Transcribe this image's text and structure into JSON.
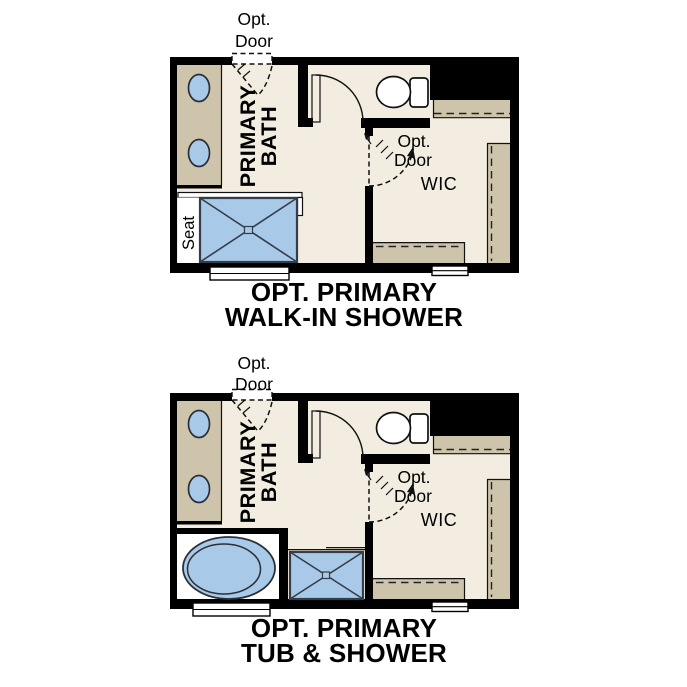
{
  "page": {
    "background": "#ffffff",
    "description": "Two stacked floor-plan option diagrams for a primary bathroom"
  },
  "colors": {
    "wall": "#000000",
    "floor": "#f2ede0",
    "casework": "#cdc4ab",
    "fixture_fill": "#a9c9e8",
    "fixture_outline": "#2b3038",
    "glass": "#ffffff",
    "label_text": "#000000"
  },
  "figures": [
    {
      "id": "walk-in-shower-option",
      "caption": {
        "line1": "OPT. PRIMARY",
        "line2": "WALK-IN SHOWER"
      },
      "labels": {
        "opt_door_top_line1": "Opt.",
        "opt_door_top_line2": "Door",
        "room_line1": "PRIMARY",
        "room_line2": "BATH",
        "opt_door_wic_line1": "Opt.",
        "opt_door_wic_line2": "Door",
        "closet": "WIC",
        "seat": "Seat"
      },
      "fixtures": [
        "double-sink-vanity",
        "toilet",
        "walk-in-shower-with-seat",
        "closet-rod-shelving",
        "windows"
      ]
    },
    {
      "id": "tub-and-shower-option",
      "caption": {
        "line1": "OPT. PRIMARY",
        "line2": "TUB & SHOWER"
      },
      "labels": {
        "opt_door_top_line1": "Opt.",
        "opt_door_top_line2": "Door",
        "room_line1": "PRIMARY",
        "room_line2": "BATH",
        "opt_door_wic_line1": "Opt.",
        "opt_door_wic_line2": "Door",
        "closet": "WIC"
      },
      "fixtures": [
        "double-sink-vanity",
        "toilet",
        "oval-tub",
        "shower",
        "closet-rod-shelving",
        "windows"
      ]
    }
  ]
}
